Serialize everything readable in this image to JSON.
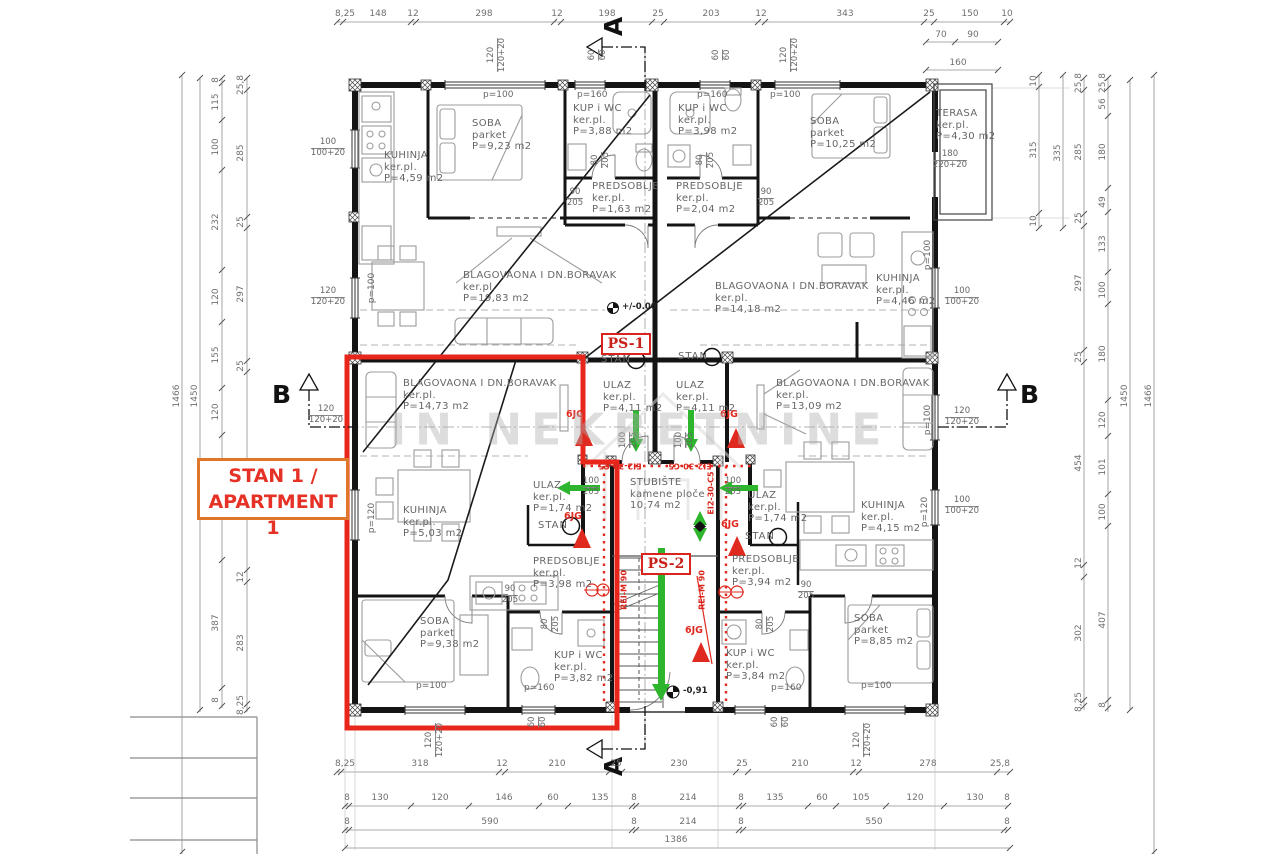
{
  "watermark": {
    "text": "IN NEKRETNINE"
  },
  "highlight": {
    "line1": "STAN 1 /",
    "line2": "APARTMENT 1"
  },
  "markers": {
    "ps1": "PS-1",
    "ps2": "PS-2",
    "level_main": "+/-0.00",
    "level_out": "-0,91",
    "stan": "STAN",
    "jg": "6JG",
    "section_a": "A",
    "section_b": "B",
    "rei": "REI-M 90",
    "ei": "EI2-30-C5"
  },
  "rooms": {
    "tl_living": {
      "name": "BLAGOVAONA I DN.BORAVAK",
      "mat": "ker.pl.",
      "area": "P=19,83 m2"
    },
    "tl_kitchen": {
      "name": "KUHINJA",
      "mat": "ker.pl.",
      "area": "P=4,59 m2"
    },
    "tl_soba": {
      "name": "SOBA",
      "mat": "parket",
      "area": "P=9,23 m2"
    },
    "tl_bath": {
      "name": "KUP i WC",
      "mat": "ker.pl.",
      "area": "P=3,88 m2"
    },
    "tl_hall": {
      "name": "PREDSOBLJE",
      "mat": "ker.pl.",
      "area": "P=1,63 m2"
    },
    "tr_living": {
      "name": "BLAGOVAONA I DN.BORAVAK",
      "mat": "ker.pl.",
      "area": "P=14,18 m2"
    },
    "tr_kitchen": {
      "name": "KUHINJA",
      "mat": "ker.pl.",
      "area": "P=4,46 m2"
    },
    "tr_soba": {
      "name": "SOBA",
      "mat": "parket",
      "area": "P=10,25 m2"
    },
    "tr_bath": {
      "name": "KUP i WC",
      "mat": "ker.pl.",
      "area": "P=3,98 m2"
    },
    "tr_hall": {
      "name": "PREDSOBLJE",
      "mat": "ker.pl.",
      "area": "P=2,04 m2"
    },
    "terrace": {
      "name": "TERASA",
      "mat": "ker.pl.",
      "area": "P=4,30 m2"
    },
    "ulaz_n": {
      "name": "ULAZ",
      "mat": "ker.pl.",
      "area": "P=4,11 m2"
    },
    "stairs": {
      "name": "STUBIŠTE",
      "mat": "kamene ploče",
      "area": "10,74 m2"
    },
    "bl_living": {
      "name": "BLAGOVAONA I DN.BORAVAK",
      "mat": "ker.pl.",
      "area": "P=14,73 m2"
    },
    "bl_kitchen": {
      "name": "KUHINJA",
      "mat": "ker.pl.",
      "area": "P=5,03 m2"
    },
    "bl_ulaz": {
      "name": "ULAZ",
      "mat": "ker.pl.",
      "area": "P=1,74 m2"
    },
    "bl_hall": {
      "name": "PREDSOBLJE",
      "mat": "ker.pl.",
      "area": "P=3,98 m2"
    },
    "bl_soba": {
      "name": "SOBA",
      "mat": "parket",
      "area": "P=9,38 m2"
    },
    "bl_bath": {
      "name": "KUP i WC",
      "mat": "ker.pl.",
      "area": "P=3,82 m2"
    },
    "br_living": {
      "name": "BLAGOVAONA I DN.BORAVAK",
      "mat": "ker.pl.",
      "area": "P=13,09 m2"
    },
    "br_kitchen": {
      "name": "KUHINJA",
      "mat": "ker.pl.",
      "area": "P=4,15 m2"
    },
    "br_ulaz": {
      "name": "ULAZ",
      "mat": "ker.pl.",
      "area": "P=1,74 m2"
    },
    "br_hall": {
      "name": "PREDSOBLJE",
      "mat": "ker.pl.",
      "area": "P=3,94 m2"
    },
    "br_soba": {
      "name": "SOBA",
      "mat": "parket",
      "area": "P=8,85 m2"
    },
    "br_bath": {
      "name": "KUP i WC",
      "mat": "ker.pl.",
      "area": "P=3,84 m2"
    }
  },
  "pairs": {
    "p90205": [
      "90",
      "205"
    ],
    "p80205": [
      "80",
      "205"
    ],
    "p100205": [
      "100",
      "205"
    ],
    "p6060": [
      "60",
      "60"
    ],
    "p120": [
      "120",
      "120+20"
    ],
    "p100": [
      "100",
      "100+20"
    ],
    "p180": [
      "180",
      "220+20"
    ]
  },
  "plabels": {
    "p100": "p=100",
    "p120": "p=120",
    "p160": "p=160"
  },
  "dims": {
    "top": [
      "8,25",
      "148",
      "12",
      "298",
      "12",
      "198",
      "25",
      "203",
      "12",
      "343",
      "25",
      "150",
      "10"
    ],
    "top_sub": [
      "70",
      "90",
      "160"
    ],
    "b1": [
      "8,25",
      "318",
      "12",
      "210",
      "25",
      "230",
      "25",
      "210",
      "12",
      "278",
      "25,8"
    ],
    "b2": [
      "8",
      "130",
      "120",
      "146",
      "60",
      "135",
      "8",
      "214",
      "8",
      "135",
      "60",
      "105",
      "120",
      "130",
      "8"
    ],
    "b3": [
      "8",
      "590",
      "8",
      "214",
      "8",
      "550",
      "8"
    ],
    "total": "1386",
    "l_out": "1466",
    "l_out2": "1450",
    "l3": [
      "8",
      "115",
      "100",
      "232",
      "120",
      "155",
      "120",
      "387",
      "8"
    ],
    "l4": [
      "25,8",
      "285",
      "25",
      "297",
      "25",
      "12",
      "283",
      "8,25"
    ],
    "r1": [
      "25,8",
      "285",
      "25",
      "297",
      "25",
      "454",
      "12",
      "302",
      "8,25"
    ],
    "r2": [
      "25,8",
      "56",
      "180",
      "49",
      "133",
      "100",
      "180",
      "120",
      "101",
      "100",
      "407",
      "8"
    ],
    "r_out": "1450",
    "r_out2": "1466",
    "tv": [
      "10",
      "315",
      "10"
    ],
    "tv2": "335",
    "terr_door": [
      "180",
      "220+20"
    ]
  }
}
